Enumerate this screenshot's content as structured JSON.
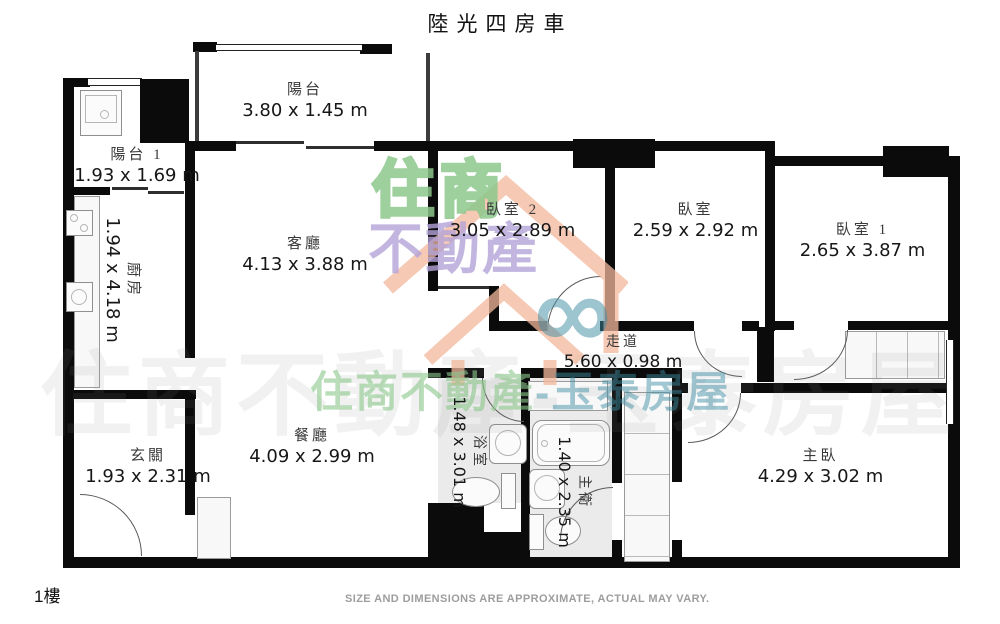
{
  "title": "陸光四房車",
  "floor_label": "1樓",
  "disclaimer": "SIZE AND DIMENSIONS ARE APPROXIMATE, ACTUAL MAY VARY.",
  "watermark": {
    "logo_top": "住商",
    "logo_bottom": "不動產",
    "logo_symbol": "∞",
    "strip_primary": "住商不動產",
    "strip_secondary": "-玉泰房屋",
    "full": "住商不動產-玉泰房屋",
    "colors": {
      "green": "#8cc88c",
      "purple": "#b4a3d8",
      "salmon": "#f2b89c",
      "teal": "#3e8ca3"
    }
  },
  "rooms": [
    {
      "name": "陽台",
      "dims": "3.80 x 1.45 m"
    },
    {
      "name": "陽台 1",
      "dims": "1.93 x 1.69 m"
    },
    {
      "name": "廚房",
      "dims": "1.94 x 4.18 m"
    },
    {
      "name": "客廳",
      "dims": "4.13 x 3.88 m"
    },
    {
      "name": "臥室 2",
      "dims": "3.05 x 2.89 m"
    },
    {
      "name": "臥室",
      "dims": "2.59 x 2.92 m"
    },
    {
      "name": "臥室 1",
      "dims": "2.65 x 3.87 m"
    },
    {
      "name": "走道",
      "dims": "5.60 x 0.98 m"
    },
    {
      "name": "餐廳",
      "dims": "4.09 x 2.99 m"
    },
    {
      "name": "浴室",
      "dims": "1.48 x 3.01 m"
    },
    {
      "name": "主衛",
      "dims": "1.40 x 2.35 m"
    },
    {
      "name": "玄關",
      "dims": "1.93 x 2.31 m"
    },
    {
      "name": "主臥",
      "dims": "4.29 x 3.02 m"
    }
  ]
}
